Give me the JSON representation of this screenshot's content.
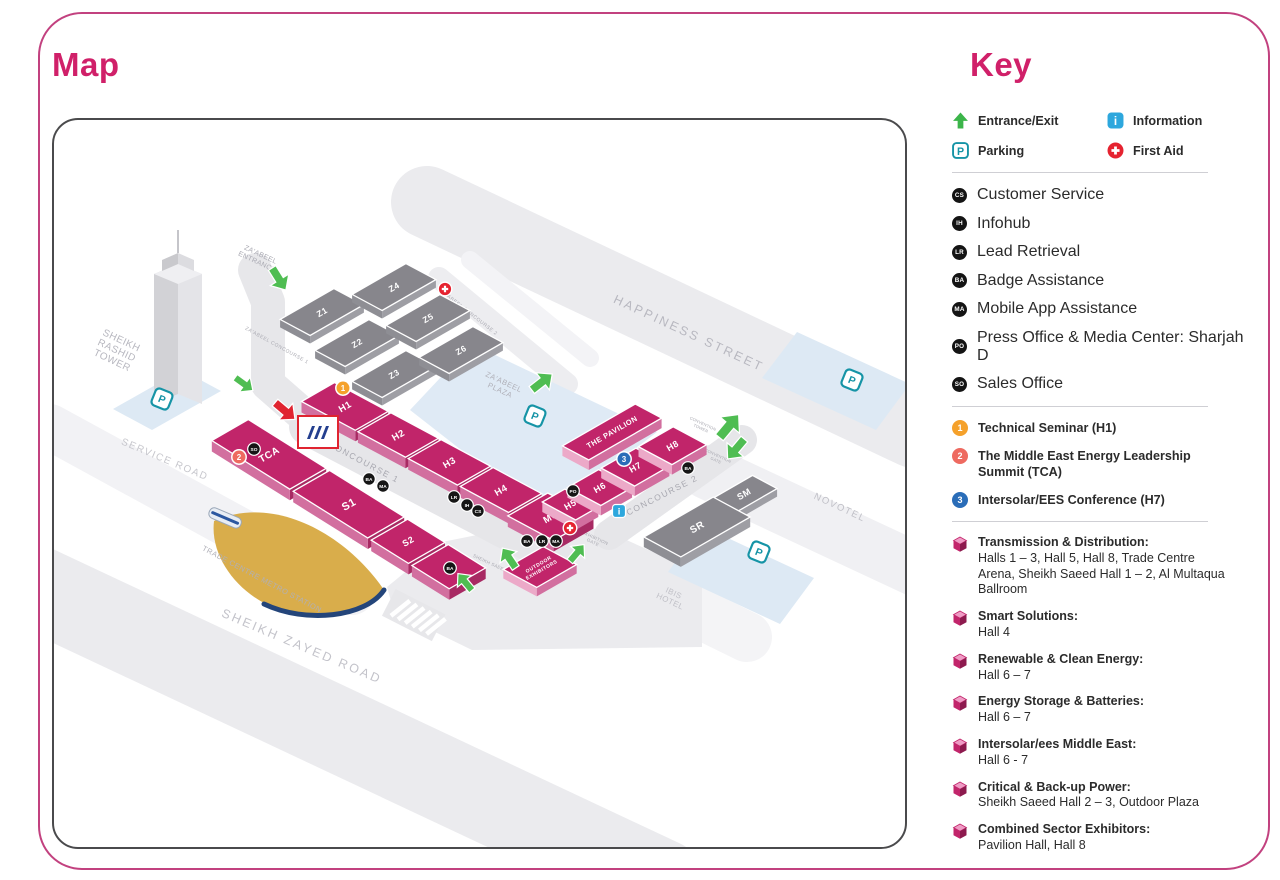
{
  "page": {
    "map_title": "Map",
    "key_title": "Key"
  },
  "key": {
    "symbols": [
      {
        "icon": "entrance-arrow-icon",
        "label": "Entrance/Exit"
      },
      {
        "icon": "information-icon",
        "label": "Information"
      },
      {
        "icon": "parking-icon",
        "label": "Parking"
      },
      {
        "icon": "first-aid-icon",
        "label": "First Aid"
      }
    ],
    "services": [
      {
        "code": "CS",
        "label": "Customer Service"
      },
      {
        "code": "IH",
        "label": "Infohub"
      },
      {
        "code": "LR",
        "label": "Lead Retrieval"
      },
      {
        "code": "BA",
        "label": "Badge Assistance"
      },
      {
        "code": "MA",
        "label": "Mobile App Assistance"
      },
      {
        "code": "PO",
        "label": "Press Office & Media Center: Sharjah D"
      },
      {
        "code": "SO",
        "label": "Sales Office"
      }
    ],
    "sessions": [
      {
        "num": "1",
        "color": "#f5a12b",
        "label": "Technical Seminar (H1)"
      },
      {
        "num": "2",
        "color": "#ee6a60",
        "label": "The Middle East Energy Leadership Summit (TCA)"
      },
      {
        "num": "3",
        "color": "#2a6db8",
        "label": "Intersolar/EES Conference (H7)"
      }
    ],
    "sectors": [
      {
        "title": "Transmission & Distribution:",
        "halls": "Halls 1 – 3, Hall 5, Hall 8, Trade Centre Arena, Sheikh Saeed Hall 1 – 2, Al Multaqua Ballroom"
      },
      {
        "title": "Smart Solutions:",
        "halls": "Hall 4"
      },
      {
        "title": "Renewable & Clean Energy:",
        "halls": "Hall 6 – 7"
      },
      {
        "title": "Energy Storage & Batteries:",
        "halls": "Hall 6 – 7"
      },
      {
        "title": "Intersolar/ees Middle East:",
        "halls": "Hall 6 - 7"
      },
      {
        "title": "Critical & Back-up Power:",
        "halls": "Sheikh Saeed Hall 2 – 3, Outdoor Plaza"
      },
      {
        "title": "Combined Sector Exhibitors:",
        "halls": "Pavilion Hall, Hall 8"
      }
    ]
  },
  "map": {
    "halls": {
      "h1": "H1",
      "h2": "H2",
      "h3": "H3",
      "h4": "H4",
      "h5": "H5",
      "h6": "H6",
      "h7": "H7",
      "h8": "H8",
      "mu": "MU",
      "tca": "TCA",
      "s1": "S1",
      "s2": "S2",
      "s3": "S3",
      "z1": "Z1",
      "z2": "Z2",
      "z3": "Z3",
      "z4": "Z4",
      "z5": "Z5",
      "z6": "Z6",
      "sr": "SR",
      "sm": "SM",
      "pavilion": "THE PAVILION",
      "outdoor": [
        "OUTDOOR",
        "EXHIBITORS"
      ]
    },
    "labels": {
      "happiness": "HAPPINESS STREET",
      "zayed": "SHEIKH ZAYED ROAD",
      "service": "SERVICE ROAD",
      "rashid": [
        "SHEIKH",
        "RASHID",
        "TOWER"
      ],
      "metro": "TRADE CENTRE METRO STATION",
      "novotel": "NOVOTEL",
      "ibis": [
        "IBIS",
        "HOTEL"
      ],
      "zplaza": [
        "ZA'ABEEL",
        "PLAZA"
      ],
      "zentrance": [
        "ZA'ABEEL",
        "ENTRANCE"
      ],
      "zc1": "ZA'ABEEL CONCOURSE 1",
      "zc2": "ZA'ABEEL CONCOURSE 2",
      "c1": "CONCOURSE 1",
      "c2": "CONCOURSE 2",
      "saeed3": "SHEIKH SAEED 3",
      "exgate": [
        "EXHIBITION",
        "GATE"
      ],
      "convtower": [
        "CONVENTION",
        "TOWER"
      ],
      "convgate": [
        "CONVENTION",
        "GATE"
      ]
    },
    "badges": {
      "cs": "CS",
      "ih": "IH",
      "lr": "LR",
      "ba": "BA",
      "ma": "MA",
      "po": "PO",
      "so": "SO"
    },
    "markers": {
      "parking": "P",
      "info": "i"
    }
  }
}
